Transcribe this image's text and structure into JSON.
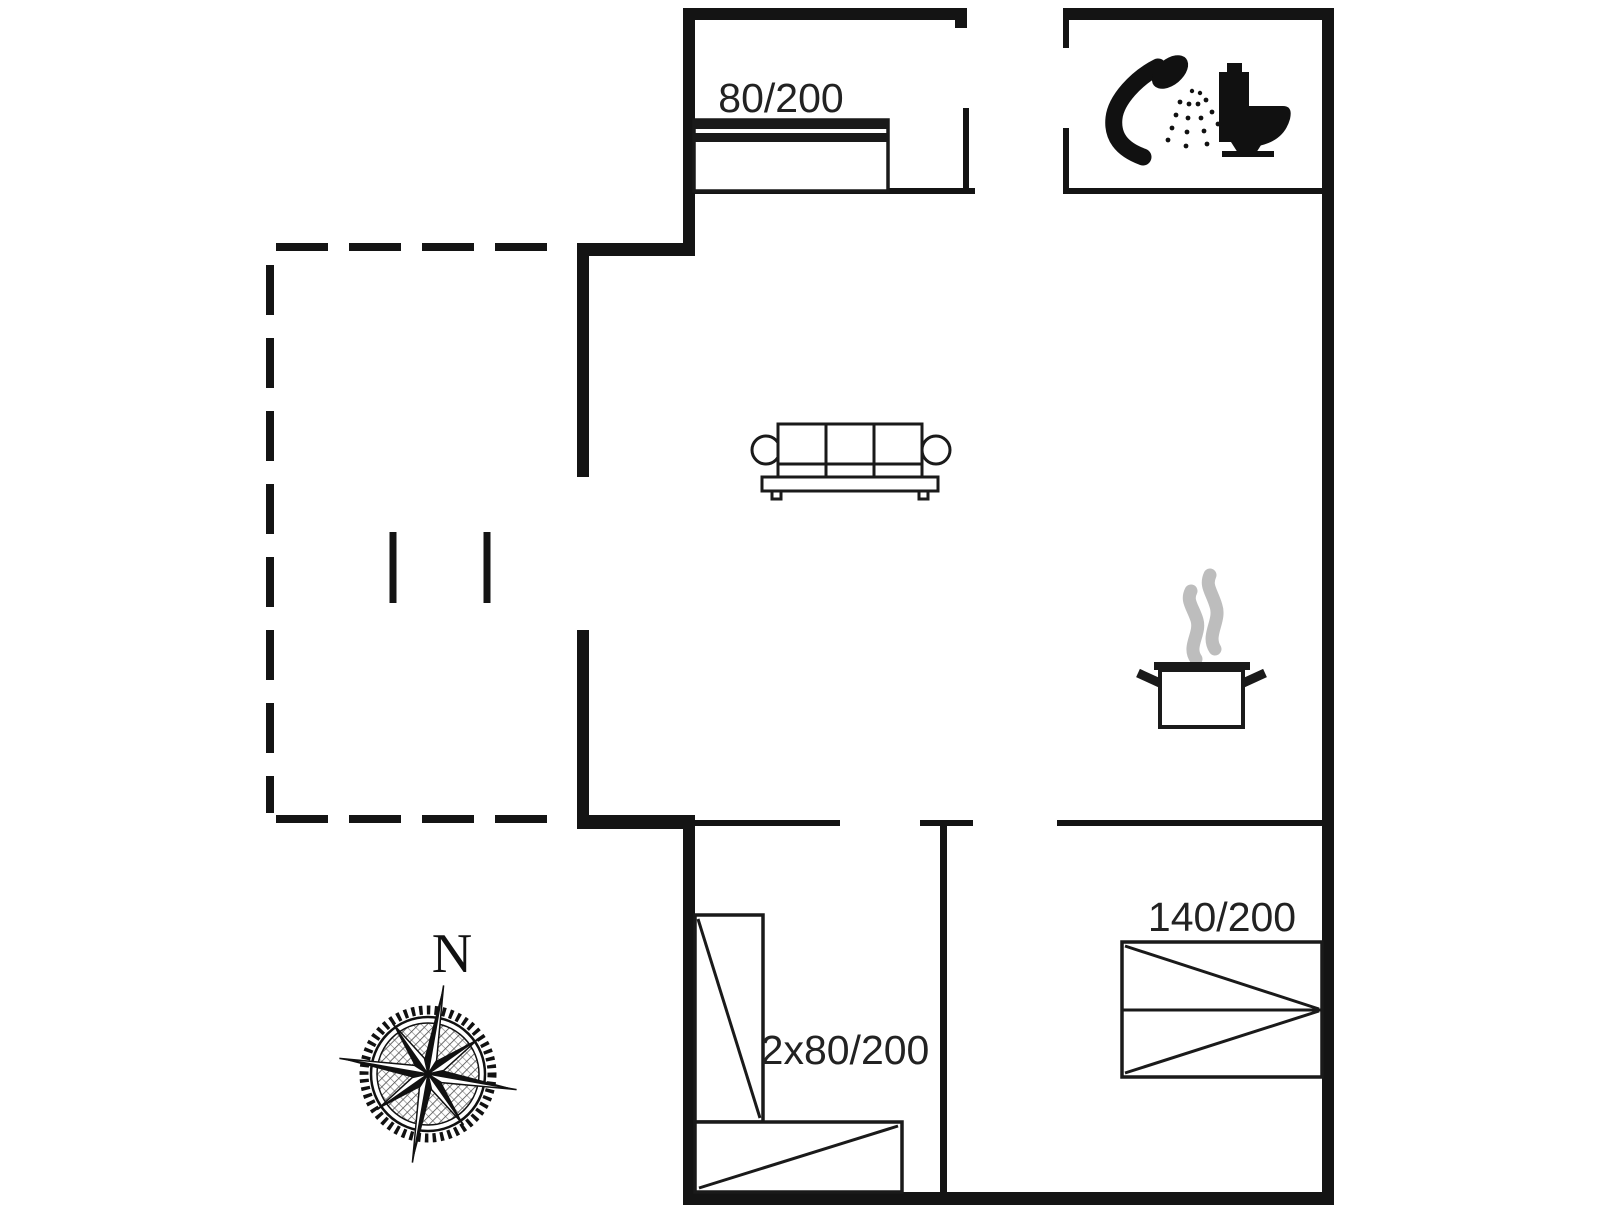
{
  "floorplan": {
    "colors": {
      "background": "#ffffff",
      "wall": "#141414",
      "furniture_line": "#1a1a1a",
      "steam": "#bdbdbd",
      "label_text": "#222222"
    },
    "labels": {
      "bed_top_left": "80/200",
      "bed_bunk": "2x80/200",
      "bed_double": "140/200",
      "compass_north": "N"
    },
    "icons": {
      "bathroom": [
        "shower-icon",
        "toilet-icon"
      ],
      "kitchen": [
        "cooking-pot-steam-icon"
      ],
      "living_room": [
        "sofa-icon"
      ],
      "bedrooms": [
        "single-bed-icon",
        "bunk-beds-icon",
        "double-bed-icon"
      ],
      "orientation": [
        "compass-rose-icon"
      ],
      "terrace": [
        "dashed-terrace-outline",
        "terrace-step-marks"
      ]
    }
  }
}
